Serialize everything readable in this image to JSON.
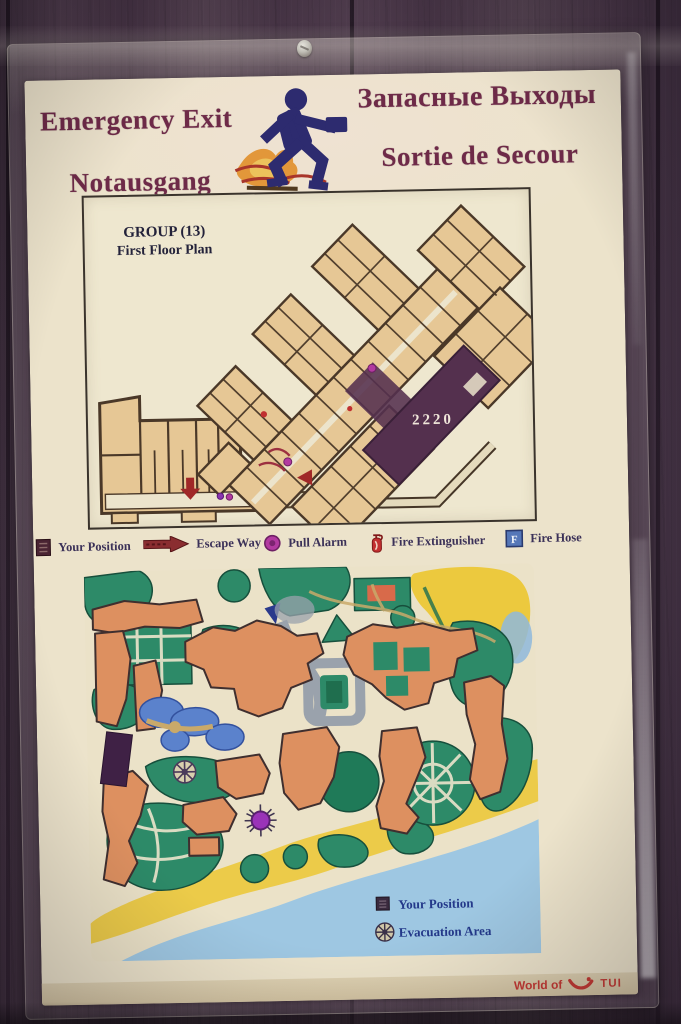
{
  "sign": {
    "title": {
      "en": "Emergency Exit",
      "de": "Notausgang",
      "ru": "Запасные Выходы",
      "fr": "Sortie de Secour"
    },
    "floor_plan": {
      "group_label": "GROUP (13)",
      "plan_label": "First Floor Plan",
      "room_number": "2220"
    },
    "legend": {
      "items": [
        {
          "icon": "your-position-square-icon",
          "label": "Your Position"
        },
        {
          "icon": "escape-way-arrow-icon",
          "label": "Escape Way"
        },
        {
          "icon": "pull-alarm-dot-icon",
          "label": "Pull Alarm"
        },
        {
          "icon": "fire-extinguisher-icon",
          "label": "Fire Extinguisher"
        },
        {
          "icon": "fire-hose-icon",
          "label": "Fire Hose",
          "icon_letter": "F"
        }
      ]
    },
    "site_map": {
      "legend": [
        {
          "icon": "your-position-square-icon",
          "label": "Your Position"
        },
        {
          "icon": "evacuation-area-star-icon",
          "label": "Evacuation Area"
        }
      ]
    },
    "footer": {
      "brand_prefix": "World of",
      "brand_name": "TUI"
    }
  },
  "colors": {
    "title_maroon": "#6e2a48",
    "runner_navy": "#2d2b6f",
    "flame_orange": "#e2973a",
    "paper_cream": "#ece3cb",
    "room_tan": "#e6c795",
    "wall_brown": "#4a3828",
    "position_block_purple": "#54304e",
    "alarm_magenta": "#b23aa0",
    "escape_red": "#8a2d30",
    "hose_blue": "#5577b8",
    "map_green": "#2d8a68",
    "map_building_orange": "#dd9060",
    "pool_blue": "#5b82cc",
    "beach_yellow": "#ecc93e",
    "sea_blue": "#9ec7e2",
    "brand_red": "#c23a34"
  }
}
